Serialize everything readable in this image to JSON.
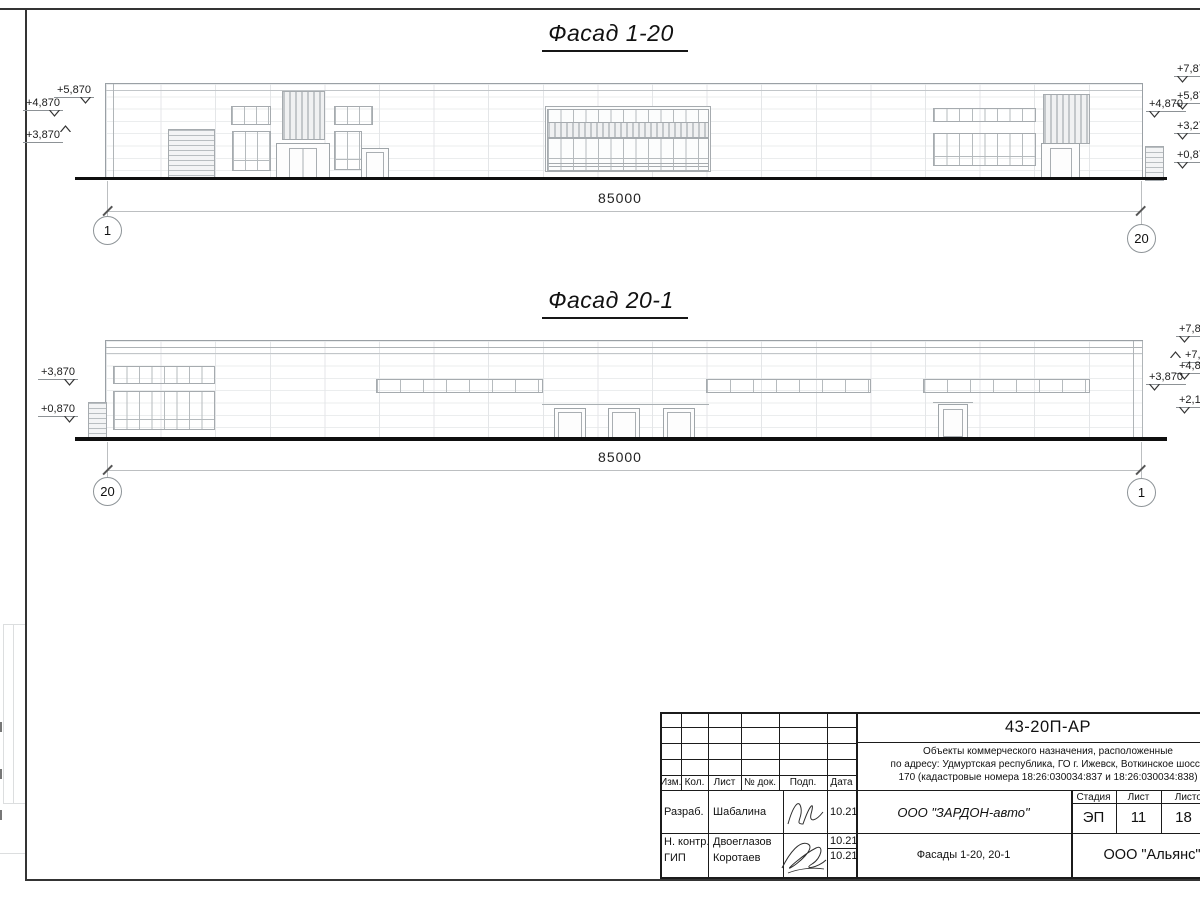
{
  "facade_top": {
    "title": "Фасад 1-20",
    "dimension": "85000",
    "axis_left": "1",
    "axis_right": "20",
    "marks_left": {
      "m1": "+5,870",
      "m2": "+4,870",
      "m3": "+3,870"
    },
    "marks_right": {
      "m1": "+7,87",
      "m2": "+5,87",
      "m3": "+4,870",
      "m4": "+3,27",
      "m5": "+0,87"
    }
  },
  "facade_bottom": {
    "title": "Фасад 20-1",
    "dimension": "85000",
    "axis_left": "20",
    "axis_right": "1",
    "marks_left": {
      "m1": "+3,870",
      "m2": "+0,870"
    },
    "marks_right": {
      "m1": "+7,8",
      "m2": "+7,",
      "m3": "+4,8",
      "m4": "+3,870",
      "m5": "+2,1"
    }
  },
  "title_block": {
    "doc_number": "43-20П-АР",
    "description_line1": "Объекты коммерческого назначения, расположенные",
    "description_line2": "по адресу: Удмуртская республика, ГО г. Ижевск, Воткинское шоссе",
    "description_line3": "170 (кадастровые номера 18:26:030034:837 и 18:26:030034:838)",
    "columns": {
      "izm": "Изм.",
      "kol": "Кол.",
      "list": "Лист",
      "doc": "№ док.",
      "podp": "Подп.",
      "data": "Дата"
    },
    "signature_rows": [
      {
        "role": "Разраб.",
        "name": "Шабалина",
        "date": "10.21"
      },
      {
        "role": "Н. контр.",
        "name": "Двоеглазов",
        "date": "10.21"
      },
      {
        "role": "ГИП",
        "name": "Коротаев",
        "date": "10.21"
      }
    ],
    "company": "ООО \"ЗАРДОН-авто\"",
    "stage_label": "Стадия",
    "sheet_label": "Лист",
    "sheets_label": "Листов",
    "stage_value": "ЭП",
    "sheet_value": "11",
    "sheets_value": "18",
    "drawing_title": "Фасады 1-20, 20-1",
    "contractor": "ООО \"Альянс\""
  }
}
